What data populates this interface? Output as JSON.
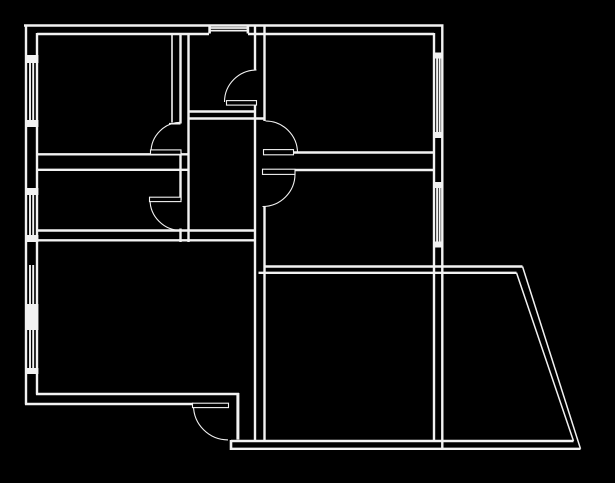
{
  "canvas": {
    "width": 615,
    "height": 483,
    "background_color": "#000000",
    "line_color": "#f2f2f2"
  },
  "floor_plan": {
    "wall_lines_legend": "x1,y1,x2,y2,stroke_width — plan wall line segments",
    "wall_lines": [
      [
        24,
        25.5,
        443.5,
        25.5,
        2.4
      ],
      [
        37,
        34,
        209,
        34,
        2.4
      ],
      [
        248,
        34,
        434,
        34,
        2.4
      ],
      [
        26,
        24.5,
        26,
        404.5,
        2.4
      ],
      [
        37,
        33,
        37,
        394.5,
        2.4
      ],
      [
        434,
        33,
        434,
        441.5,
        2.4
      ],
      [
        442.3,
        24.5,
        442.3,
        450,
        2.4
      ],
      [
        36,
        394,
        239,
        394,
        2.4
      ],
      [
        25,
        404,
        193.5,
        404,
        2.4
      ],
      [
        237.9,
        393,
        237.9,
        439.5,
        3
      ],
      [
        231,
        441,
        573.5,
        441,
        2.4
      ],
      [
        231,
        448.8,
        580.5,
        448.8,
        2.4
      ],
      [
        231,
        440,
        231,
        450,
        2.6
      ],
      [
        263.5,
        266.5,
        522.5,
        266.5,
        2.4
      ],
      [
        258.5,
        272.8,
        516.5,
        272.8,
        2.4
      ],
      [
        522.5,
        266.5,
        580.5,
        448.8,
        1.5
      ],
      [
        516.5,
        272.8,
        573.5,
        441,
        1.5
      ],
      [
        180.5,
        34,
        180.5,
        123.5,
        2.4
      ],
      [
        180.5,
        152.5,
        180.5,
        200,
        2.4
      ],
      [
        180.5,
        228.5,
        180.5,
        242,
        2.4
      ],
      [
        188.5,
        34,
        188.5,
        242,
        2.4
      ],
      [
        255,
        24.5,
        255,
        69.5,
        2.4
      ],
      [
        255,
        102.5,
        255,
        441,
        2.4
      ],
      [
        264.5,
        25,
        264.5,
        121,
        2.4
      ],
      [
        264.5,
        206.5,
        264.5,
        441,
        2.4
      ],
      [
        36,
        154.3,
        188.5,
        154.3,
        2.4
      ],
      [
        36,
        169.8,
        188.5,
        169.8,
        2.4
      ],
      [
        293.5,
        152.5,
        434,
        152.5,
        2.4
      ],
      [
        295.5,
        170,
        434,
        170,
        2.4
      ],
      [
        188,
        111.5,
        255.5,
        111.5,
        2.4
      ],
      [
        188,
        118.5,
        265,
        118.5,
        2.4
      ],
      [
        36,
        230.5,
        254.5,
        230.5,
        2.4
      ],
      [
        36,
        240.3,
        254.5,
        240.3,
        2.4
      ],
      [
        172,
        34,
        172,
        122.5,
        1.6
      ],
      [
        169,
        123.7,
        180.5,
        123.7,
        1.6
      ]
    ],
    "window_lines_legend": "x1,y1,x2,y2,stroke_width — glazing hatch lines of window symbols",
    "window_lines": [
      [
        30,
        63,
        30,
        120,
        1.9
      ],
      [
        33.2,
        63,
        33.2,
        120,
        1.9
      ],
      [
        30,
        195,
        30,
        235,
        1.9
      ],
      [
        33.2,
        195,
        33.2,
        235,
        1.9
      ],
      [
        30,
        265,
        30,
        305,
        1.9
      ],
      [
        33.2,
        265,
        33.2,
        305,
        1.9
      ],
      [
        30,
        330,
        30,
        368,
        1.9
      ],
      [
        33.2,
        330,
        33.2,
        368,
        1.9
      ],
      [
        437.1,
        58,
        437.1,
        132,
        1.9
      ],
      [
        439.7,
        58,
        439.7,
        132,
        1.9
      ],
      [
        437.1,
        188,
        437.1,
        242,
        1.9
      ],
      [
        439.7,
        188,
        439.7,
        242,
        1.9
      ],
      [
        210,
        28,
        247,
        28,
        1.7
      ],
      [
        210,
        30.6,
        247,
        30.6,
        1.7
      ]
    ],
    "wall_blocks_legend": "x,y,w,h — solid filled wall piers and window end caps",
    "wall_blocks": [
      [
        25,
        55,
        13.4,
        8
      ],
      [
        25,
        120,
        13.4,
        7
      ],
      [
        25,
        188,
        13.4,
        7
      ],
      [
        25,
        235,
        13.4,
        7
      ],
      [
        25,
        304,
        13.4,
        26
      ],
      [
        25,
        368,
        13.4,
        6
      ],
      [
        433,
        52.5,
        10.3,
        6
      ],
      [
        433,
        132,
        10.3,
        6
      ],
      [
        433,
        182,
        10.3,
        6
      ],
      [
        433,
        241.5,
        10.3,
        6
      ],
      [
        208.3,
        24.5,
        2.6,
        9
      ],
      [
        246.6,
        24.5,
        2.6,
        9
      ]
    ],
    "doors": [
      {
        "name": "top-middle-room-door",
        "leaf": [
          226.5,
          100.6,
          30,
          4.5
        ],
        "arc": {
          "cx": 256.5,
          "cy": 102,
          "r": 32,
          "start": 180,
          "end": 270,
          "sweep": 1
        }
      },
      {
        "name": "top-left-room-door",
        "leaf": [
          150.5,
          149.9,
          30.5,
          4.4
        ],
        "arc": {
          "cx": 181,
          "cy": 152.3,
          "r": 30,
          "start": 180,
          "end": 270,
          "sweep": 1
        }
      },
      {
        "name": "top-right-room-door",
        "leaf": [
          263.5,
          149.6,
          30,
          5.2
        ],
        "arc": {
          "cx": 265.5,
          "cy": 153,
          "r": 32,
          "start": 270,
          "end": 360,
          "sweep": 1
        }
      },
      {
        "name": "mid-right-room-door",
        "leaf": [
          262.5,
          169.2,
          32.5,
          5.2
        ],
        "arc": {
          "cx": 262.5,
          "cy": 174,
          "r": 32.5,
          "start": 0,
          "end": 90,
          "sweep": 1
        }
      },
      {
        "name": "mid-left-room-door",
        "leaf": [
          149.5,
          197.2,
          31.5,
          4.4
        ],
        "arc": {
          "cx": 181,
          "cy": 199.5,
          "r": 31,
          "start": 180,
          "end": 90,
          "sweep": 0
        }
      },
      {
        "name": "entry-door",
        "leaf": [
          192.5,
          403.2,
          36,
          4.4
        ],
        "arc": {
          "cx": 228,
          "cy": 405.4,
          "r": 34.5,
          "start": 180,
          "end": 90,
          "sweep": 0
        }
      }
    ]
  }
}
